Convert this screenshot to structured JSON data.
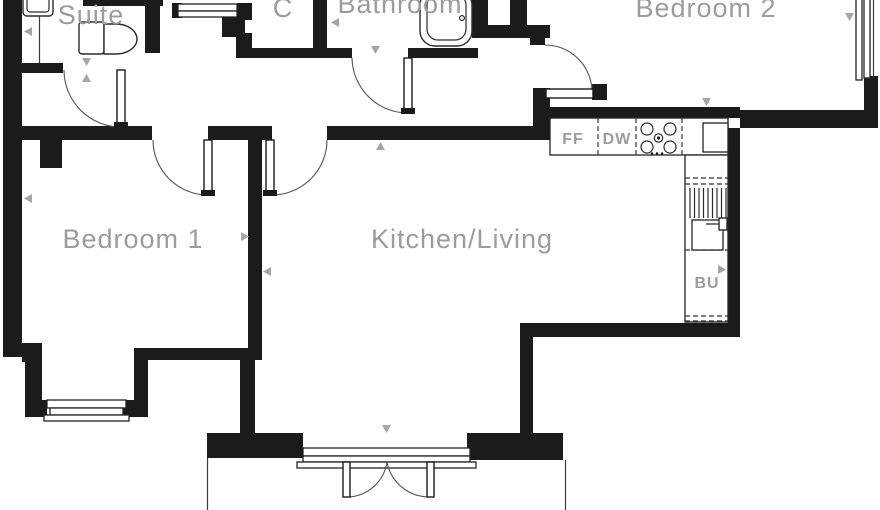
{
  "plan": {
    "title": "apartment-floor-plan",
    "rooms": {
      "suite": {
        "label": "Suite"
      },
      "closet": {
        "label": "C"
      },
      "bathroom": {
        "label": "Bathroom"
      },
      "bedroom2": {
        "label": "Bedroom 2"
      },
      "bedroom1": {
        "label": "Bedroom 1"
      },
      "kitchen_living": {
        "label": "Kitchen/Living"
      }
    },
    "appliances": {
      "fridge_freezer": {
        "label": "FF"
      },
      "dishwasher": {
        "label": "DW"
      },
      "boiler_unit": {
        "label": "BU"
      }
    },
    "colors": {
      "wall": "#1b1b1b",
      "room_label": "#9c9c9c",
      "dimension_marker": "#a5a5a5",
      "fixture_line": "#2a2a2a",
      "background": "#ffffff"
    },
    "icons": [
      "dimension-arrow-icon",
      "door-swing-icon",
      "window-icon",
      "bathtub-icon",
      "toilet-icon",
      "basin-icon",
      "hob-icon",
      "sink-icon",
      "drainer-icon",
      "french-doors-icon"
    ]
  }
}
